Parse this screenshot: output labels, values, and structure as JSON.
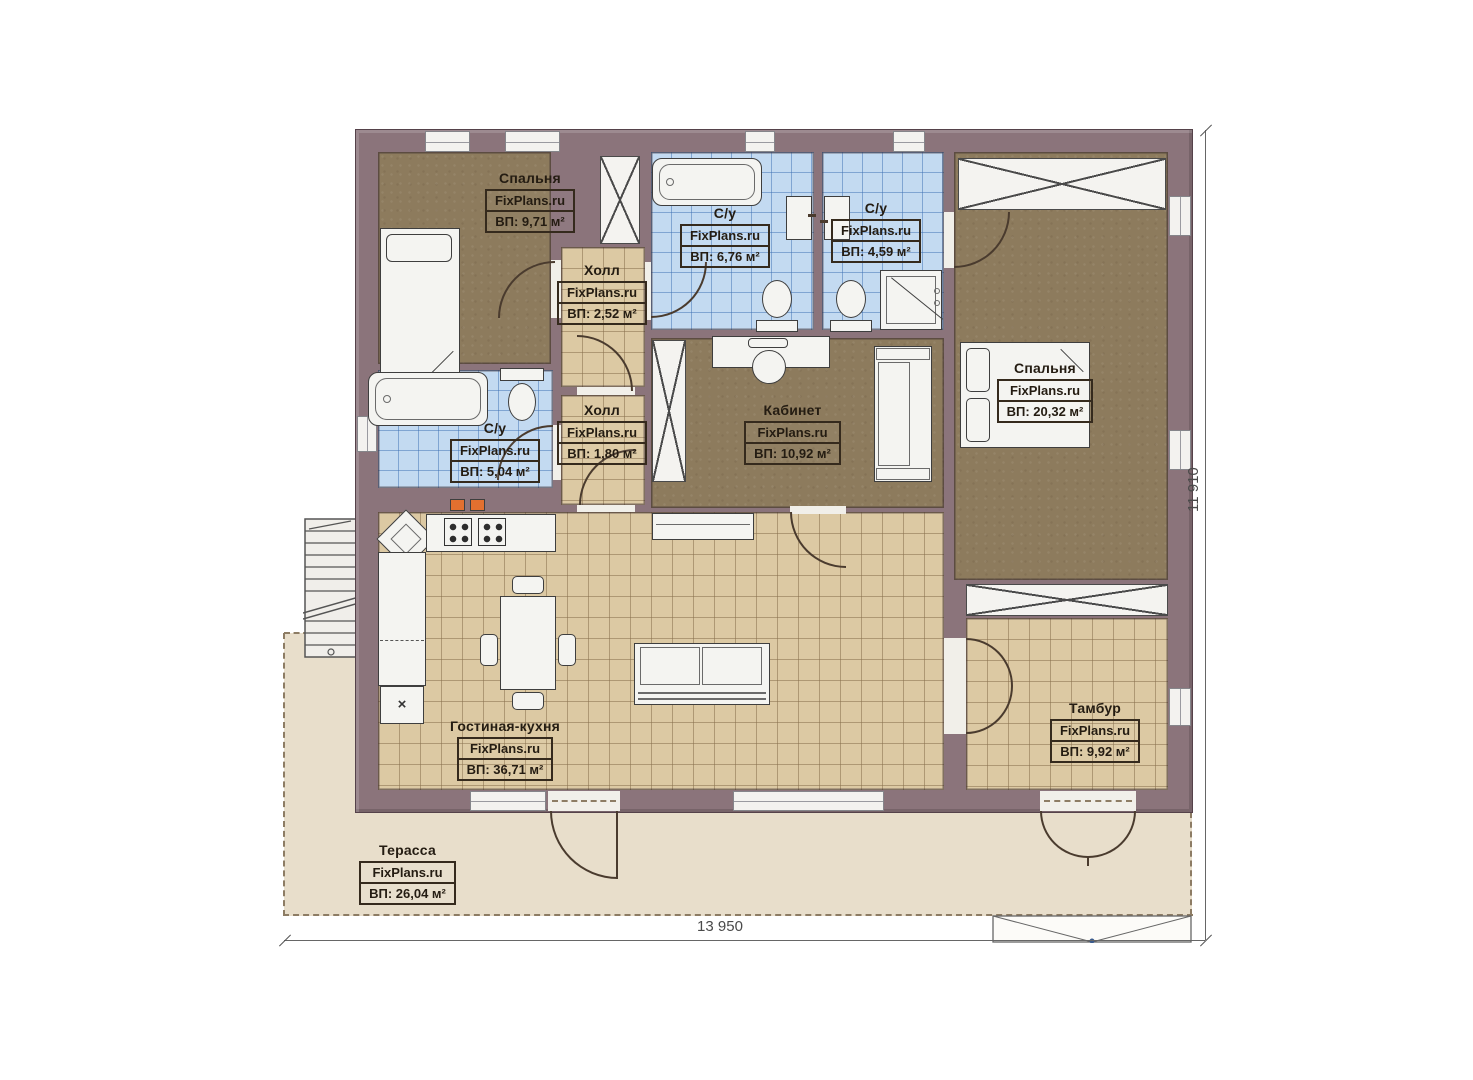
{
  "plan": {
    "brand": "FixPlans.ru",
    "rooms": [
      {
        "name": "Спальня",
        "site": "FixPlans.ru",
        "area": "ВП: 9,71 м²"
      },
      {
        "name": "С/у",
        "site": "FixPlans.ru",
        "area": "ВП: 6,76 м²"
      },
      {
        "name": "С/у",
        "site": "FixPlans.ru",
        "area": "ВП: 4,59 м²"
      },
      {
        "name": "Холл",
        "site": "FixPlans.ru",
        "area": "ВП: 2,52 м²"
      },
      {
        "name": "С/у",
        "site": "FixPlans.ru",
        "area": "ВП: 5,04 м²"
      },
      {
        "name": "Холл",
        "site": "FixPlans.ru",
        "area": "ВП: 1,80 м²"
      },
      {
        "name": "Кабинет",
        "site": "FixPlans.ru",
        "area": "ВП: 10,92 м²"
      },
      {
        "name": "Спальня",
        "site": "FixPlans.ru",
        "area": "ВП: 20,32 м²"
      },
      {
        "name": "Гостиная-кухня",
        "site": "FixPlans.ru",
        "area": "ВП: 36,71 м²"
      },
      {
        "name": "Тамбур",
        "site": "FixPlans.ru",
        "area": "ВП: 9,92 м²"
      },
      {
        "name": "Терасса",
        "site": "FixPlans.ru",
        "area": "ВП: 26,04 м²"
      }
    ],
    "dimensions": {
      "width": "13 950",
      "height": "11 910"
    },
    "symbols": {
      "fridge": "×"
    },
    "colors": {
      "wall": "#8b747b",
      "room_brown": "#8d7b5d",
      "tile_tan": "#dcc9a3",
      "tile_blue": "#c3daf1",
      "terrace": "#e8decb",
      "fixture": "#f4f4f1",
      "vent_orange": "#e2702f"
    }
  }
}
